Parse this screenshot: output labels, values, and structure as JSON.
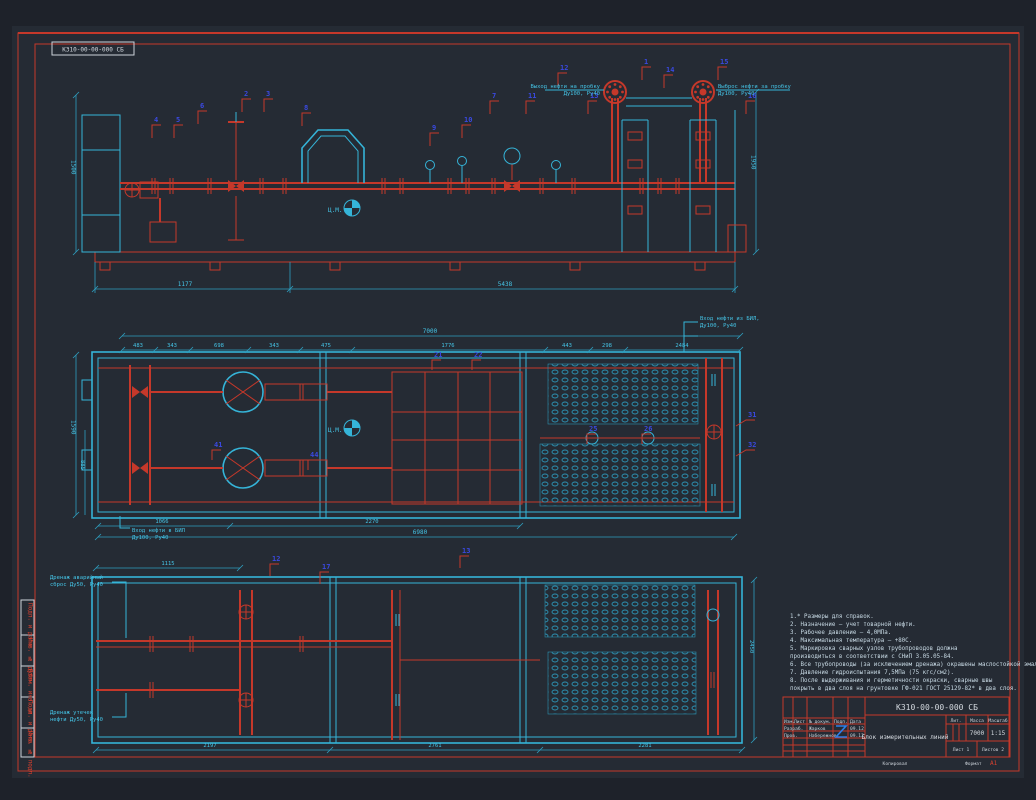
{
  "sheet": {
    "corner_code": "К310-00-00-000 СБ",
    "cm_label": "Ц.М."
  },
  "labels": {
    "out_top_left": {
      "l1": "Выход нефти на пробку",
      "l2": "Ду100, Ру40"
    },
    "out_top_right": {
      "l1": "Выброс нефти за пробку",
      "l2": "Ду100, Ру40"
    },
    "plan_in_right": {
      "l1": "Вход нефти из БИЛ,",
      "l2": "Ду100, Ру40"
    },
    "plan_in_left": {
      "l1": "Вход нефти в БИЛ",
      "l2": "Ду100, Ру40"
    },
    "drain_emergency": {
      "l1": "Дренаж аварийный",
      "l2": "сброс Ду50, Ру40"
    },
    "drain_leak": {
      "l1": "Дренаж утечек",
      "l2": "нефти Ду50, Ру40"
    }
  },
  "dims": {
    "top": {
      "h_left": "1500",
      "h_right": "1950",
      "b1": "1177",
      "b2": "5438"
    },
    "plan": {
      "total": "7000",
      "segs": [
        "483",
        "343",
        "698",
        "343",
        "475",
        "1776",
        "443",
        "298",
        "2484"
      ],
      "bot1": "1066",
      "bot2": "2270",
      "bot_total": "6980",
      "left1": "1590",
      "left2": "885"
    },
    "lower": {
      "top1": "1115",
      "b1": "2197",
      "b2": "2761",
      "b3": "2281",
      "right": "2450"
    }
  },
  "callouts": {
    "top": [
      "4",
      "5",
      "6",
      "2",
      "3",
      "8",
      "9",
      "10",
      "7",
      "11",
      "12",
      "13",
      "1",
      "14",
      "15",
      "16"
    ],
    "plan": [
      "21",
      "22",
      "25",
      "26",
      "31",
      "32",
      "41",
      "44"
    ],
    "lower": [
      "12",
      "13",
      "17"
    ]
  },
  "notes": {
    "lines": [
      "1.* Размеры для справок.",
      "2. Назначение — учет товарной нефти.",
      "3. Рабочее давление — 4,0МПа.",
      "4. Максимальная температура — +80С.",
      "5. Маркировка сварных узлов трубопроводов должна",
      "производиться в соответствии с  СНиП 3.05.05-84.",
      "6. Все трубопроводы (за исключением дренажа) окрашены маслостойкой эмалью.",
      "7. Давление гидроиспытания 7,5МПа (75 кгс/см2).",
      "8. После выдерживания и герметичности окраски, сварные швы",
      "покрыть в два слоя на грунтовке ГФ-021 ГОСТ 25129-82* в два слоя."
    ]
  },
  "titleblock": {
    "code": "К310-00-00-000 СБ",
    "title": "Блок измерительных линий",
    "col_lit": "Лит.",
    "col_mass": "Масса",
    "col_scale": "Масштаб",
    "mass": "7000",
    "scale": "1:15",
    "sheet": "Лист 1",
    "sheets": "Листов 2",
    "hdr": [
      "Изм.",
      "Лист",
      "№ докум.",
      "Подп.",
      "Дата"
    ],
    "row1_role": "Разраб.",
    "row1_name": "Жарков",
    "row1_date": "09.12",
    "row2_role": "Пров.",
    "row2_name": "Набережнов",
    "row2_date": "09.12",
    "copied": "Копировал",
    "format_label": "Формат",
    "format_value": "А1"
  },
  "margin_boxes": [
    "Подп. и дата",
    "Инв. № дубл.",
    "Взам. инв. №",
    "Подп. и дата",
    "Инв. № подл."
  ]
}
